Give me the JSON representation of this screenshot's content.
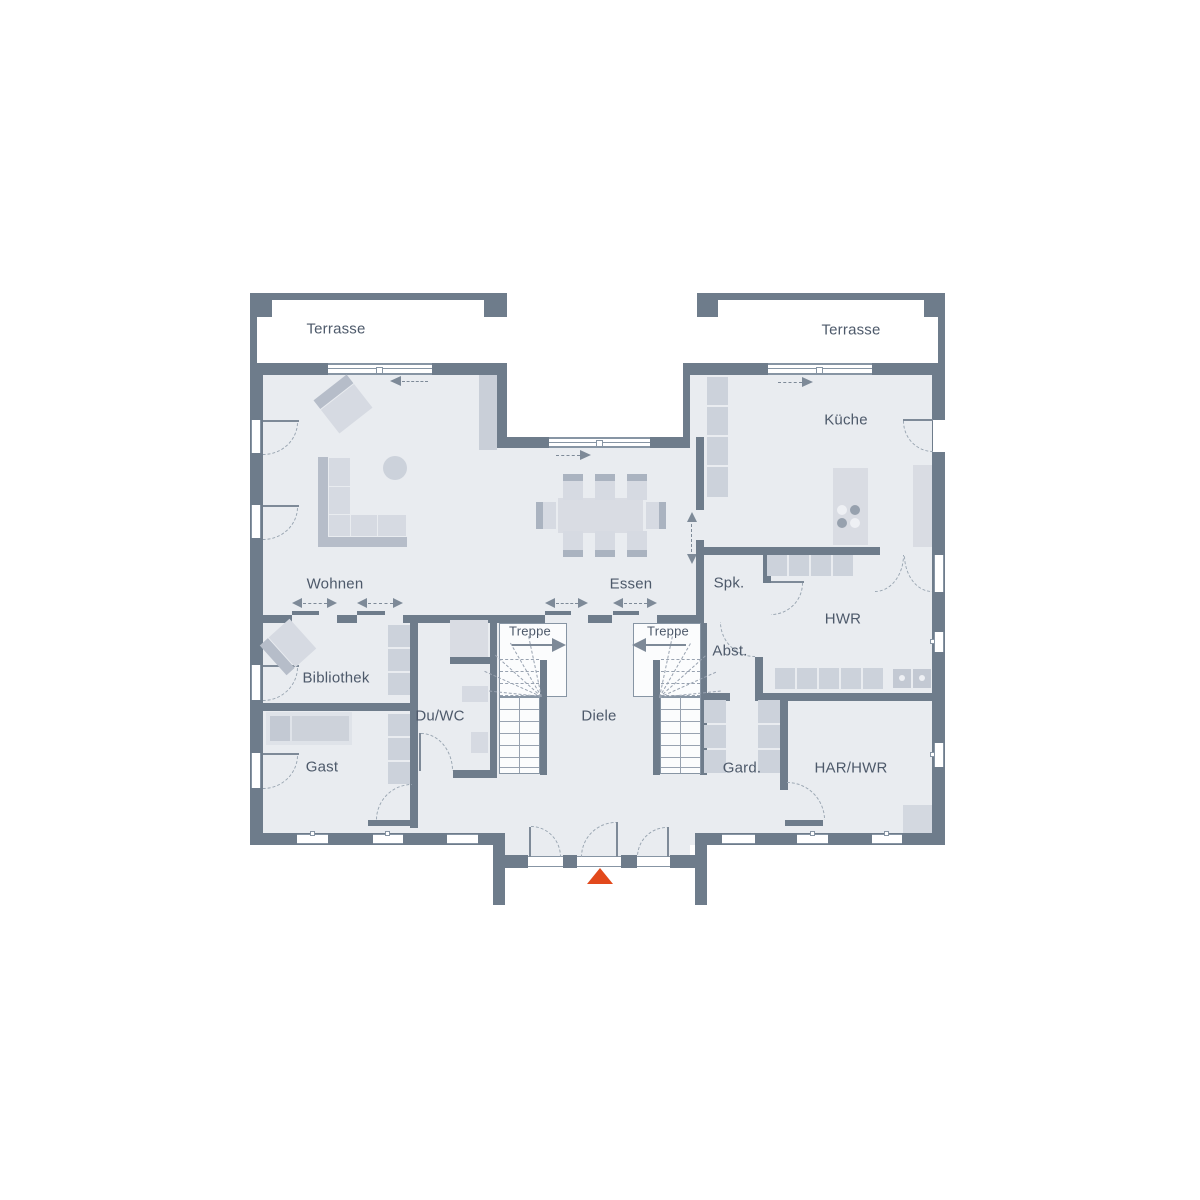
{
  "rooms": {
    "terrasse_left": "Terrasse",
    "terrasse_right": "Terrasse",
    "kueche": "Küche",
    "wohnen": "Wohnen",
    "essen": "Essen",
    "spk": "Spk.",
    "hwr": "HWR",
    "bibliothek": "Bibliothek",
    "treppe_left": "Treppe",
    "treppe_right": "Treppe",
    "abst": "Abst.",
    "du_wc": "Du/WC",
    "diele": "Diele",
    "gast": "Gast",
    "gard": "Gard.",
    "har_hwr": "HAR/HWR"
  },
  "colors": {
    "wall": "#6e7c8b",
    "floor": "#e9ecf0",
    "furn": "#d6dae2",
    "furn2": "#ccd2db",
    "furndark": "#b6bdc9",
    "line": "#8795a4",
    "arc": "#9aa6b2",
    "label": "#4d596a",
    "accent": "#e2491c",
    "stairbg": "#fbfcfd"
  },
  "icons": {
    "entrance_marker": "triangle-up",
    "sliding_door": "double-headed-dashed-arrow",
    "door": "quarter-arc"
  }
}
